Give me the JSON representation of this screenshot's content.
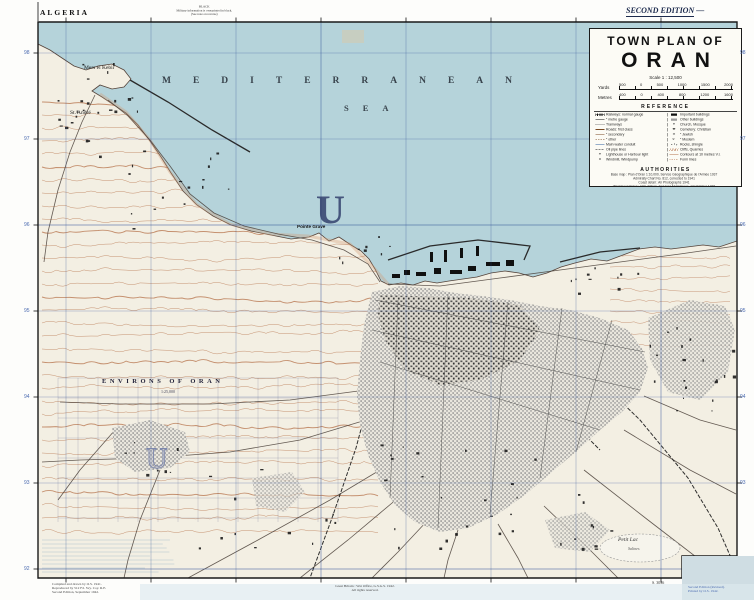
{
  "colors": {
    "sea": "#b5d3da",
    "land": "#f3efe3",
    "contour": "#b5714a",
    "grid": "#2e4f96",
    "city_gray": "#8f8f8f",
    "navy": "#26335c"
  },
  "margin": {
    "country_label": "ALGERIA",
    "edition_label": "SECOND EDITION",
    "edition_dash": "—",
    "top_note_lines": [
      "BLACK",
      "Military information is overprinted in black.",
      "(See note on reverse)"
    ],
    "imprint_left_lines": [
      "Compiled and drawn by O.S. 1941.",
      "Reproduced by 512 Fd. Svy. Coy. R.E.",
      "Second Edition, September 1942."
    ],
    "imprint_center_lines": [
      "Great Britain : War Office, G.S.G.S. 1942.",
      "All rights reserved."
    ],
    "sheet_note": "S. 3036",
    "cut_note_lines": [
      "Second Edition (Revised).",
      "Printed by O.S. 1942."
    ],
    "grid_numbers": [
      "98",
      "97",
      "96",
      "95",
      "94",
      "93",
      "92"
    ]
  },
  "map": {
    "sea_label_top": "MEDITERRANEAN",
    "sea_label_bottom": "SEA",
    "grid_letter_sea": "U",
    "grid_letter_land": "U",
    "labels": [
      {
        "text": "Mers el Kebir"
      },
      {
        "text": "St. André"
      },
      {
        "text": "Pointe Grave"
      },
      {
        "text": "ENVIRONS OF ORAN"
      },
      {
        "text": "1:25,000"
      },
      {
        "text": "Petit Lac"
      },
      {
        "text": "Salines"
      }
    ]
  },
  "title_box": {
    "line1": "TOWN PLAN OF",
    "line2": "ORAN",
    "scale_text": "Scale 1 : 12,500",
    "scale_bars": [
      {
        "unit": "Yards",
        "ticks": "500 0 500 1000 1500 2000"
      },
      {
        "unit": "Metres",
        "ticks": "400 0 400 800 1200 1600"
      }
    ],
    "reference_heading": "REFERENCE",
    "legend_left": [
      {
        "t": "Railways: normal gauge",
        "s": "s-rail"
      },
      {
        "t": "″  metre gauge",
        "s": "s-rail2"
      },
      {
        "t": "Tramways",
        "s": "s-tram"
      },
      {
        "t": "Roads: first class",
        "s": "s-road1"
      },
      {
        "t": "″  secondary",
        "s": "s-road2"
      },
      {
        "t": "″  other",
        "s": "s-road3"
      },
      {
        "t": "Main water conduit",
        "s": "s-water"
      },
      {
        "t": "Oil pipe lines",
        "s": "s-oil"
      },
      {
        "t": "Lighthouse or Harbour light",
        "g": "✶"
      },
      {
        "t": "Windmill, Windpump",
        "g": "⨯"
      }
    ],
    "legend_right": [
      {
        "t": "Important buildings",
        "s": "s-blk"
      },
      {
        "t": "Other buildings",
        "s": "s-gry"
      },
      {
        "t": "Church, Mosque",
        "g": "✝"
      },
      {
        "t": "Cemetery: Christian",
        "g": "✚"
      },
      {
        "t": "″  Jewish",
        "g": "✡"
      },
      {
        "t": "″  Moslem",
        "g": "☪"
      },
      {
        "t": "Rocks, shingle",
        "s": "s-rocks"
      },
      {
        "t": "Cliffs, Quarries",
        "s": "s-cliff"
      },
      {
        "t": "Contours at 10 metres V.I.",
        "s": "s-cont"
      },
      {
        "t": "Form lines",
        "s": "s-form"
      }
    ],
    "authorities_heading": "AUTHORITIES",
    "authorities_lines": [
      "Base map : Plan d'Oran 1:10,000, Service Géographique de l'Armée 1937",
      "Admiralty Chart No. 812, corrected to 1941",
      "Coast detail : Air Photographs 1941",
      "Ward boundaries : Ville d'Oran, Services Municipaux, 1st October 1938",
      "Intelligence Reports, March 1941",
      "Aerodrome information : Air Ministry 1941"
    ]
  }
}
